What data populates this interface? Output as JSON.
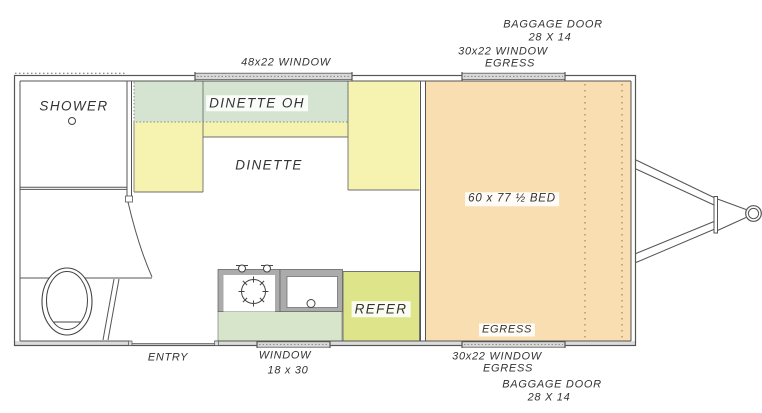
{
  "colors": {
    "bed_fill": "#f8deb1",
    "seat_fill": "#f6f2b0",
    "overhead_cabinet_fill": "#d4e4d0",
    "counter_fill": "#d7e6ca",
    "refer_fill": "#dee489",
    "wall_line": "#555555",
    "appliance_gray": "#ababab",
    "window_marker_fill": "#d9d9d9",
    "text": "#333333"
  },
  "labels": {
    "exterior_top": {
      "baggage_door": "BAGGAGE DOOR",
      "baggage_door_size": "28 X 14",
      "window_30": "30x22 WINDOW",
      "window_30_egress": "EGRESS",
      "window_48": "48x22 WINDOW"
    },
    "exterior_bottom": {
      "entry": "ENTRY",
      "window": "WINDOW",
      "window_size": "18 x 30",
      "window_30": "30x22 WINDOW",
      "window_30_egress": "EGRESS",
      "baggage_door": "BAGGAGE DOOR",
      "baggage_door_size": "28 X 14"
    },
    "interior": {
      "shower": "SHOWER",
      "dinette_oh": "DINETTE OH",
      "dinette": "DINETTE",
      "bed": "60 x 77 ½ BED",
      "bed_egress": "EGRESS",
      "refer": "REFER"
    }
  }
}
